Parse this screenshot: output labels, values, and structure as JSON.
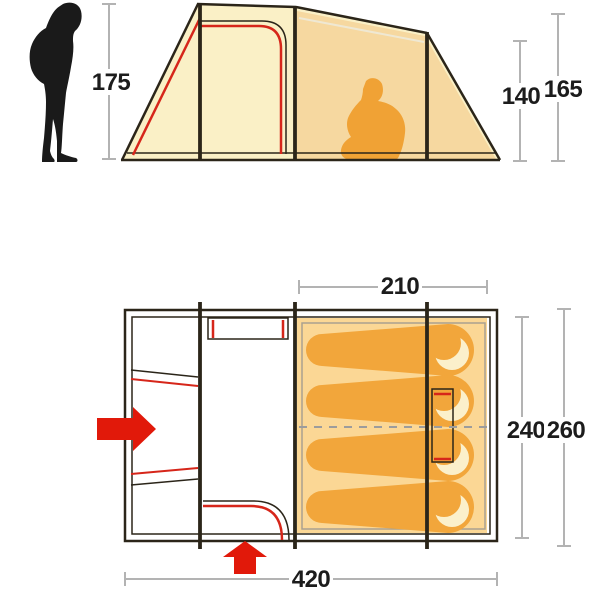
{
  "title": "tent-dimensions-diagram",
  "side_view": {
    "labels": {
      "person_height": "175",
      "inner_height": "140",
      "peak_height": "165"
    },
    "figures": {
      "standing_person": "adult-height-reference",
      "seated_person": "seated-camper-inside-inner-tent"
    }
  },
  "floor_plan": {
    "labels": {
      "inner_width": "210",
      "inner_depth": "240",
      "outer_depth": "260",
      "total_length": "420"
    },
    "sleeping_positions": 4,
    "entrances": {
      "side_arrow": "left-side-entrance",
      "front_arrow": "front-entrance"
    }
  },
  "colors": {
    "canvas_cream": "#FAF0C6",
    "inner_shade": "#F6D8A0",
    "floor_orange": "#FBD795",
    "bag_orange": "#F2A63B",
    "pillow_cream": "#FBF0CB",
    "outline_dark": "#2B2519",
    "accent_red": "#D6261A",
    "arrow_red": "#E1190A",
    "dim_gray": "#B3B3B3",
    "label_black": "#1C1C1C",
    "silhouette_black": "#1A1A1A",
    "camper_orange": "#F0A235"
  }
}
